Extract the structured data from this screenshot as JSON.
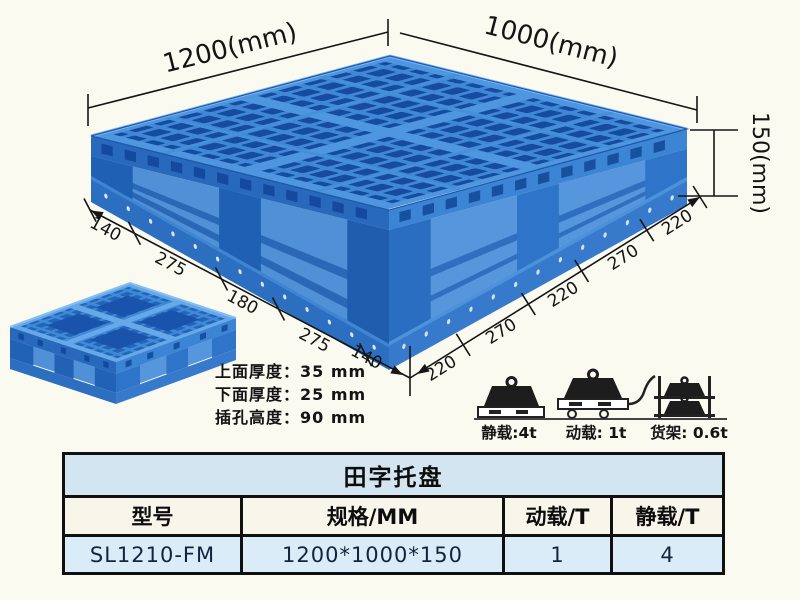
{
  "diagram": {
    "top_width_label": "1200(mm)",
    "top_depth_label": "1000(mm)",
    "height_label": "150(mm)",
    "left_edge_dims": [
      "140",
      "275",
      "180",
      "275",
      "140"
    ],
    "right_edge_dims": [
      "220",
      "270",
      "220",
      "270",
      "220"
    ],
    "thickness_notes": [
      "上面厚度：35 mm",
      "下面厚度：25 mm",
      "插孔高度：90 mm"
    ]
  },
  "load_icons": [
    {
      "name": "static-load",
      "label": "静载:4t"
    },
    {
      "name": "dynamic-load",
      "label": "动载: 1t"
    },
    {
      "name": "rack-load",
      "label": "货架: 0.6t"
    }
  ],
  "table": {
    "title": "田字托盘",
    "headers": [
      "型号",
      "规格/MM",
      "动载/T",
      "静载/T"
    ],
    "rows": [
      [
        "SL1210-FM",
        "1200*1000*150",
        "1",
        "4"
      ]
    ]
  },
  "colors": {
    "pallet_rib_blue": "#3c87d8",
    "pallet_hole_blue": "#1b50a8",
    "pallet_side_blue": "#2e76cc",
    "background_cream": "#fbfaf0",
    "table_title_bg": "#d2e5f1",
    "table_row_bg": "#d9ecf7",
    "line_black": "#151515"
  }
}
